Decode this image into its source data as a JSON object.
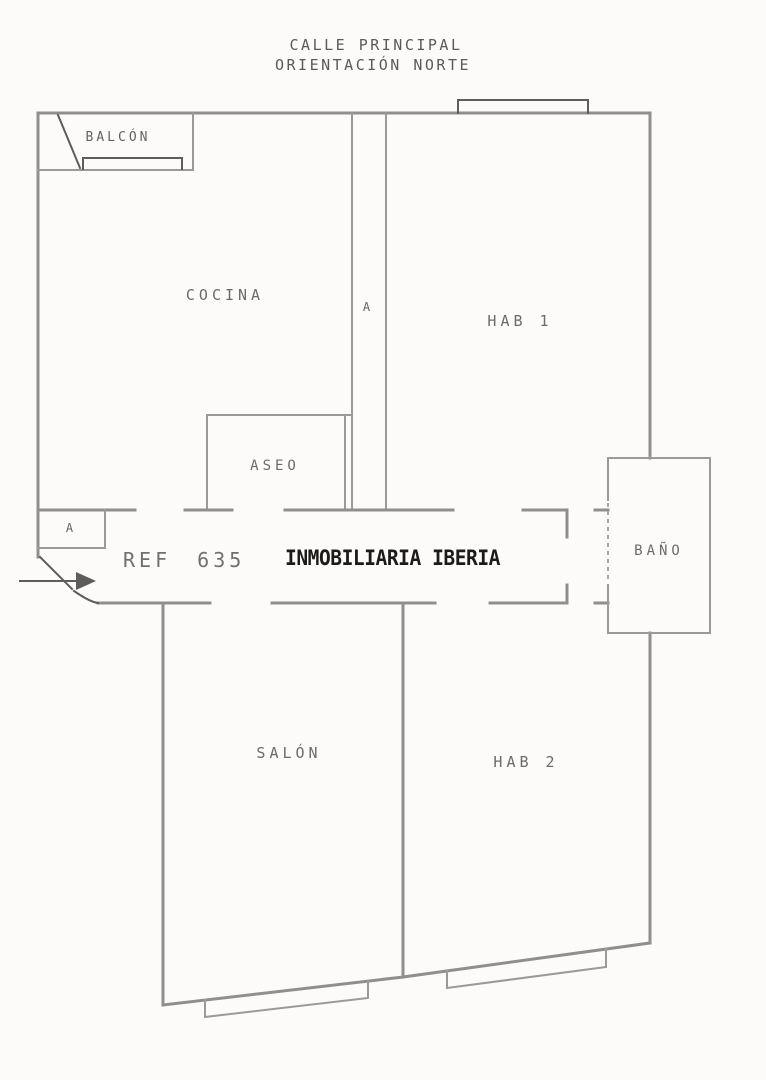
{
  "page": {
    "background": "#fcfbf9"
  },
  "colors": {
    "wall": "#8f8f8f",
    "wall_thin": "#9a9a9a",
    "detail_dark": "#5d5d5d",
    "label_text": "#6b6b6b",
    "header_text": "#5a5a5a",
    "reference_text": "#707070",
    "watermark_text": "#1b1b1b"
  },
  "symbols": {
    "entrance_arrow": "right-arrow"
  },
  "header": {
    "line1": "CALLE PRINCIPAL",
    "line2": "ORIENTACIÓN NORTE"
  },
  "plan": {
    "reference": "REF 635",
    "watermark": "INMOBILIARIA IBERIA",
    "rooms": {
      "balcon": {
        "label": "BALCÓN"
      },
      "cocina": {
        "label": "COCINA"
      },
      "vent_shaft": {
        "label": "A"
      },
      "hab1": {
        "label": "HAB 1"
      },
      "aseo": {
        "label": "ASEO"
      },
      "closet": {
        "label": "A"
      },
      "bano": {
        "label": "BAÑO"
      },
      "salon": {
        "label": "SALÓN"
      },
      "hab2": {
        "label": "HAB 2"
      }
    }
  }
}
